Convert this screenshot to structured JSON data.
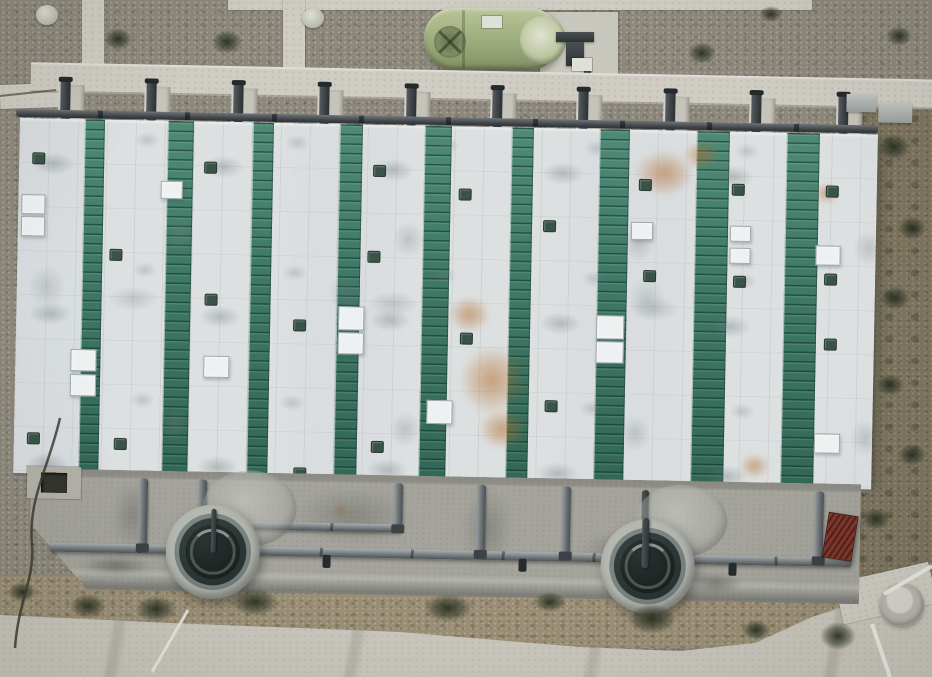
{
  "meta": {
    "description": "Aerial drone photo of a wastewater treatment facility: long building with alternating green and white striped roof, top service walkway with pipe risers, horizontal green storage tank, concrete apron with pipework and two circular clarifier tanks, gravel and grass grounds with shrubs, concrete road along the bottom"
  },
  "palette": {
    "gravel": "#8d887b",
    "grass": "#7d745e",
    "dirt": "#9a8e75",
    "road": "#c9c6bc",
    "path": "#cfccc3",
    "roof_white": "#dde0e1",
    "roof_green": "#3f7a67",
    "vent": "#3a5348",
    "apron": "#a4a49c",
    "stair_red": "#7c382e"
  },
  "roof": {
    "green_stripes": [
      {
        "x": 65,
        "w": 20
      },
      {
        "x": 148,
        "w": 26
      },
      {
        "x": 233,
        "w": 21
      },
      {
        "x": 320,
        "w": 23
      },
      {
        "x": 405,
        "w": 27
      },
      {
        "x": 492,
        "w": 22
      },
      {
        "x": 580,
        "w": 30
      },
      {
        "x": 677,
        "w": 33
      },
      {
        "x": 767,
        "w": 33
      }
    ],
    "vents": [
      {
        "x": 13,
        "y": 34
      },
      {
        "x": 13,
        "y": 314
      },
      {
        "x": 92,
        "y": 129
      },
      {
        "x": 100,
        "y": 318
      },
      {
        "x": 185,
        "y": 40
      },
      {
        "x": 188,
        "y": 172
      },
      {
        "x": 277,
        "y": 196
      },
      {
        "x": 280,
        "y": 344
      },
      {
        "x": 354,
        "y": 40
      },
      {
        "x": 350,
        "y": 126
      },
      {
        "x": 357,
        "y": 316
      },
      {
        "x": 440,
        "y": 62
      },
      {
        "x": 444,
        "y": 206
      },
      {
        "x": 525,
        "y": 92
      },
      {
        "x": 530,
        "y": 272
      },
      {
        "x": 620,
        "y": 49
      },
      {
        "x": 626,
        "y": 140
      },
      {
        "x": 713,
        "y": 52
      },
      {
        "x": 716,
        "y": 144
      },
      {
        "x": 807,
        "y": 52
      },
      {
        "x": 807,
        "y": 140
      },
      {
        "x": 808,
        "y": 205
      }
    ],
    "skylights": [
      {
        "x": 3,
        "y": 76,
        "w": 24,
        "h": 20
      },
      {
        "x": 3,
        "y": 98,
        "w": 24,
        "h": 20
      },
      {
        "x": 55,
        "y": 230,
        "w": 26,
        "h": 22
      },
      {
        "x": 55,
        "y": 255,
        "w": 26,
        "h": 22
      },
      {
        "x": 142,
        "y": 60,
        "w": 22,
        "h": 18
      },
      {
        "x": 188,
        "y": 234,
        "w": 26,
        "h": 22
      },
      {
        "x": 322,
        "y": 182,
        "w": 26,
        "h": 24
      },
      {
        "x": 322,
        "y": 208,
        "w": 26,
        "h": 22
      },
      {
        "x": 412,
        "y": 274,
        "w": 26,
        "h": 24
      },
      {
        "x": 580,
        "y": 186,
        "w": 28,
        "h": 24
      },
      {
        "x": 580,
        "y": 212,
        "w": 28,
        "h": 22
      },
      {
        "x": 613,
        "y": 92,
        "w": 22,
        "h": 18
      },
      {
        "x": 712,
        "y": 94,
        "w": 21,
        "h": 16
      },
      {
        "x": 712,
        "y": 116,
        "w": 21,
        "h": 16
      },
      {
        "x": 798,
        "y": 112,
        "w": 25,
        "h": 20
      },
      {
        "x": 800,
        "y": 300,
        "w": 26,
        "h": 20
      }
    ],
    "rust_stains": [
      {
        "x": 615,
        "y": 20,
        "w": 60,
        "h": 46
      },
      {
        "x": 664,
        "y": 10,
        "w": 36,
        "h": 28
      },
      {
        "x": 432,
        "y": 170,
        "w": 42,
        "h": 36
      },
      {
        "x": 444,
        "y": 218,
        "w": 66,
        "h": 70
      },
      {
        "x": 464,
        "y": 282,
        "w": 48,
        "h": 40
      },
      {
        "x": 726,
        "y": 322,
        "w": 30,
        "h": 24
      },
      {
        "x": 796,
        "y": 50,
        "w": 24,
        "h": 20
      }
    ]
  },
  "walkway": {
    "piers": [
      {
        "x": 58
      },
      {
        "x": 144
      },
      {
        "x": 231
      },
      {
        "x": 317
      },
      {
        "x": 404
      },
      {
        "x": 490
      },
      {
        "x": 576
      },
      {
        "x": 663
      },
      {
        "x": 749
      },
      {
        "x": 836
      }
    ],
    "risers": [
      {
        "x": 60
      },
      {
        "x": 146
      },
      {
        "x": 233
      },
      {
        "x": 319
      },
      {
        "x": 406
      },
      {
        "x": 492
      },
      {
        "x": 578
      },
      {
        "x": 665
      },
      {
        "x": 751
      },
      {
        "x": 838
      }
    ]
  },
  "apron": {
    "pipes": [
      {
        "cls": "h",
        "x": 58,
        "y": 542,
        "w": 802,
        "h": 9
      },
      {
        "cls": "h",
        "x": 250,
        "y": 517,
        "w": 160,
        "h": 8
      },
      {
        "cls": "v",
        "x": 146,
        "y": 476,
        "w": 9,
        "h": 72
      },
      {
        "cls": "v",
        "x": 205,
        "y": 476,
        "w": 9,
        "h": 38
      },
      {
        "cls": "v",
        "x": 401,
        "y": 476,
        "w": 9,
        "h": 48
      },
      {
        "cls": "v",
        "x": 484,
        "y": 476,
        "w": 9,
        "h": 72
      },
      {
        "cls": "v",
        "x": 569,
        "y": 476,
        "w": 9,
        "h": 72
      },
      {
        "cls": "v",
        "x": 822,
        "y": 476,
        "w": 9,
        "h": 72
      },
      {
        "cls": "dark",
        "x": 649,
        "y": 478,
        "w": 7,
        "h": 80
      },
      {
        "cls": "valve",
        "x": 331,
        "y": 549,
        "w": 8,
        "h": 13
      },
      {
        "cls": "valve",
        "x": 527,
        "y": 549,
        "w": 8,
        "h": 13
      },
      {
        "cls": "valve",
        "x": 737,
        "y": 549,
        "w": 8,
        "h": 13
      }
    ],
    "tanks": [
      {
        "cls": "dome",
        "x": 210,
        "y": 466,
        "w": 94,
        "h": 76
      },
      {
        "cls": "dome",
        "x": 643,
        "y": 472,
        "w": 92,
        "h": 72
      },
      {
        "cls": "tank",
        "x": 174,
        "y": 501,
        "w": 94,
        "h": 94
      },
      {
        "cls": "tank",
        "x": 609,
        "y": 507,
        "w": 94,
        "h": 94
      }
    ],
    "overpipes": [
      {
        "cls": "dark",
        "x": 219,
        "y": 505,
        "w": 5,
        "h": 44
      },
      {
        "cls": "dark",
        "x": 650,
        "y": 506,
        "w": 7,
        "h": 50
      }
    ],
    "stains": [
      {
        "cls": "dk",
        "x": 120,
        "y": 478,
        "w": 40,
        "h": 70
      },
      {
        "cls": "dk",
        "x": 300,
        "y": 480,
        "w": 120,
        "h": 60
      },
      {
        "cls": "dk",
        "x": 470,
        "y": 478,
        "w": 50,
        "h": 84
      },
      {
        "cls": "dk",
        "x": 585,
        "y": 520,
        "w": 90,
        "h": 40
      },
      {
        "cls": "dk2",
        "x": 696,
        "y": 560,
        "w": 56,
        "h": 20
      },
      {
        "cls": "dk2",
        "x": 90,
        "y": 555,
        "w": 70,
        "h": 18
      },
      {
        "cls": "rs",
        "x": 340,
        "y": 498,
        "w": 16,
        "h": 12
      }
    ]
  },
  "ground": {
    "manholes": [
      {
        "x": 36,
        "y": 5,
        "w": 22,
        "h": 20
      },
      {
        "x": 302,
        "y": 8,
        "w": 22,
        "h": 20
      }
    ],
    "shrubs": [
      {
        "x": 104,
        "y": 28,
        "w": 28,
        "h": 22
      },
      {
        "x": 212,
        "y": 30,
        "w": 30,
        "h": 24
      },
      {
        "x": 688,
        "y": 42,
        "w": 28,
        "h": 22
      },
      {
        "x": 760,
        "y": 6,
        "w": 22,
        "h": 16
      },
      {
        "x": 886,
        "y": 26,
        "w": 26,
        "h": 20
      },
      {
        "x": 878,
        "y": 134,
        "w": 32,
        "h": 26
      },
      {
        "x": 898,
        "y": 216,
        "w": 28,
        "h": 24
      },
      {
        "x": 880,
        "y": 286,
        "w": 30,
        "h": 24
      },
      {
        "x": 876,
        "y": 374,
        "w": 28,
        "h": 22
      },
      {
        "x": 898,
        "y": 444,
        "w": 28,
        "h": 22
      },
      {
        "x": 862,
        "y": 508,
        "w": 28,
        "h": 22
      },
      {
        "x": 8,
        "y": 582,
        "w": 28,
        "h": 20
      },
      {
        "x": 70,
        "y": 594,
        "w": 36,
        "h": 24
      },
      {
        "x": 136,
        "y": 596,
        "w": 40,
        "h": 26
      },
      {
        "x": 232,
        "y": 588,
        "w": 46,
        "h": 28
      },
      {
        "x": 424,
        "y": 594,
        "w": 48,
        "h": 28
      },
      {
        "x": 534,
        "y": 592,
        "w": 32,
        "h": 20
      },
      {
        "x": 628,
        "y": 604,
        "w": 48,
        "h": 30
      },
      {
        "x": 742,
        "y": 620,
        "w": 28,
        "h": 20
      },
      {
        "x": 820,
        "y": 622,
        "w": 36,
        "h": 28
      }
    ]
  }
}
